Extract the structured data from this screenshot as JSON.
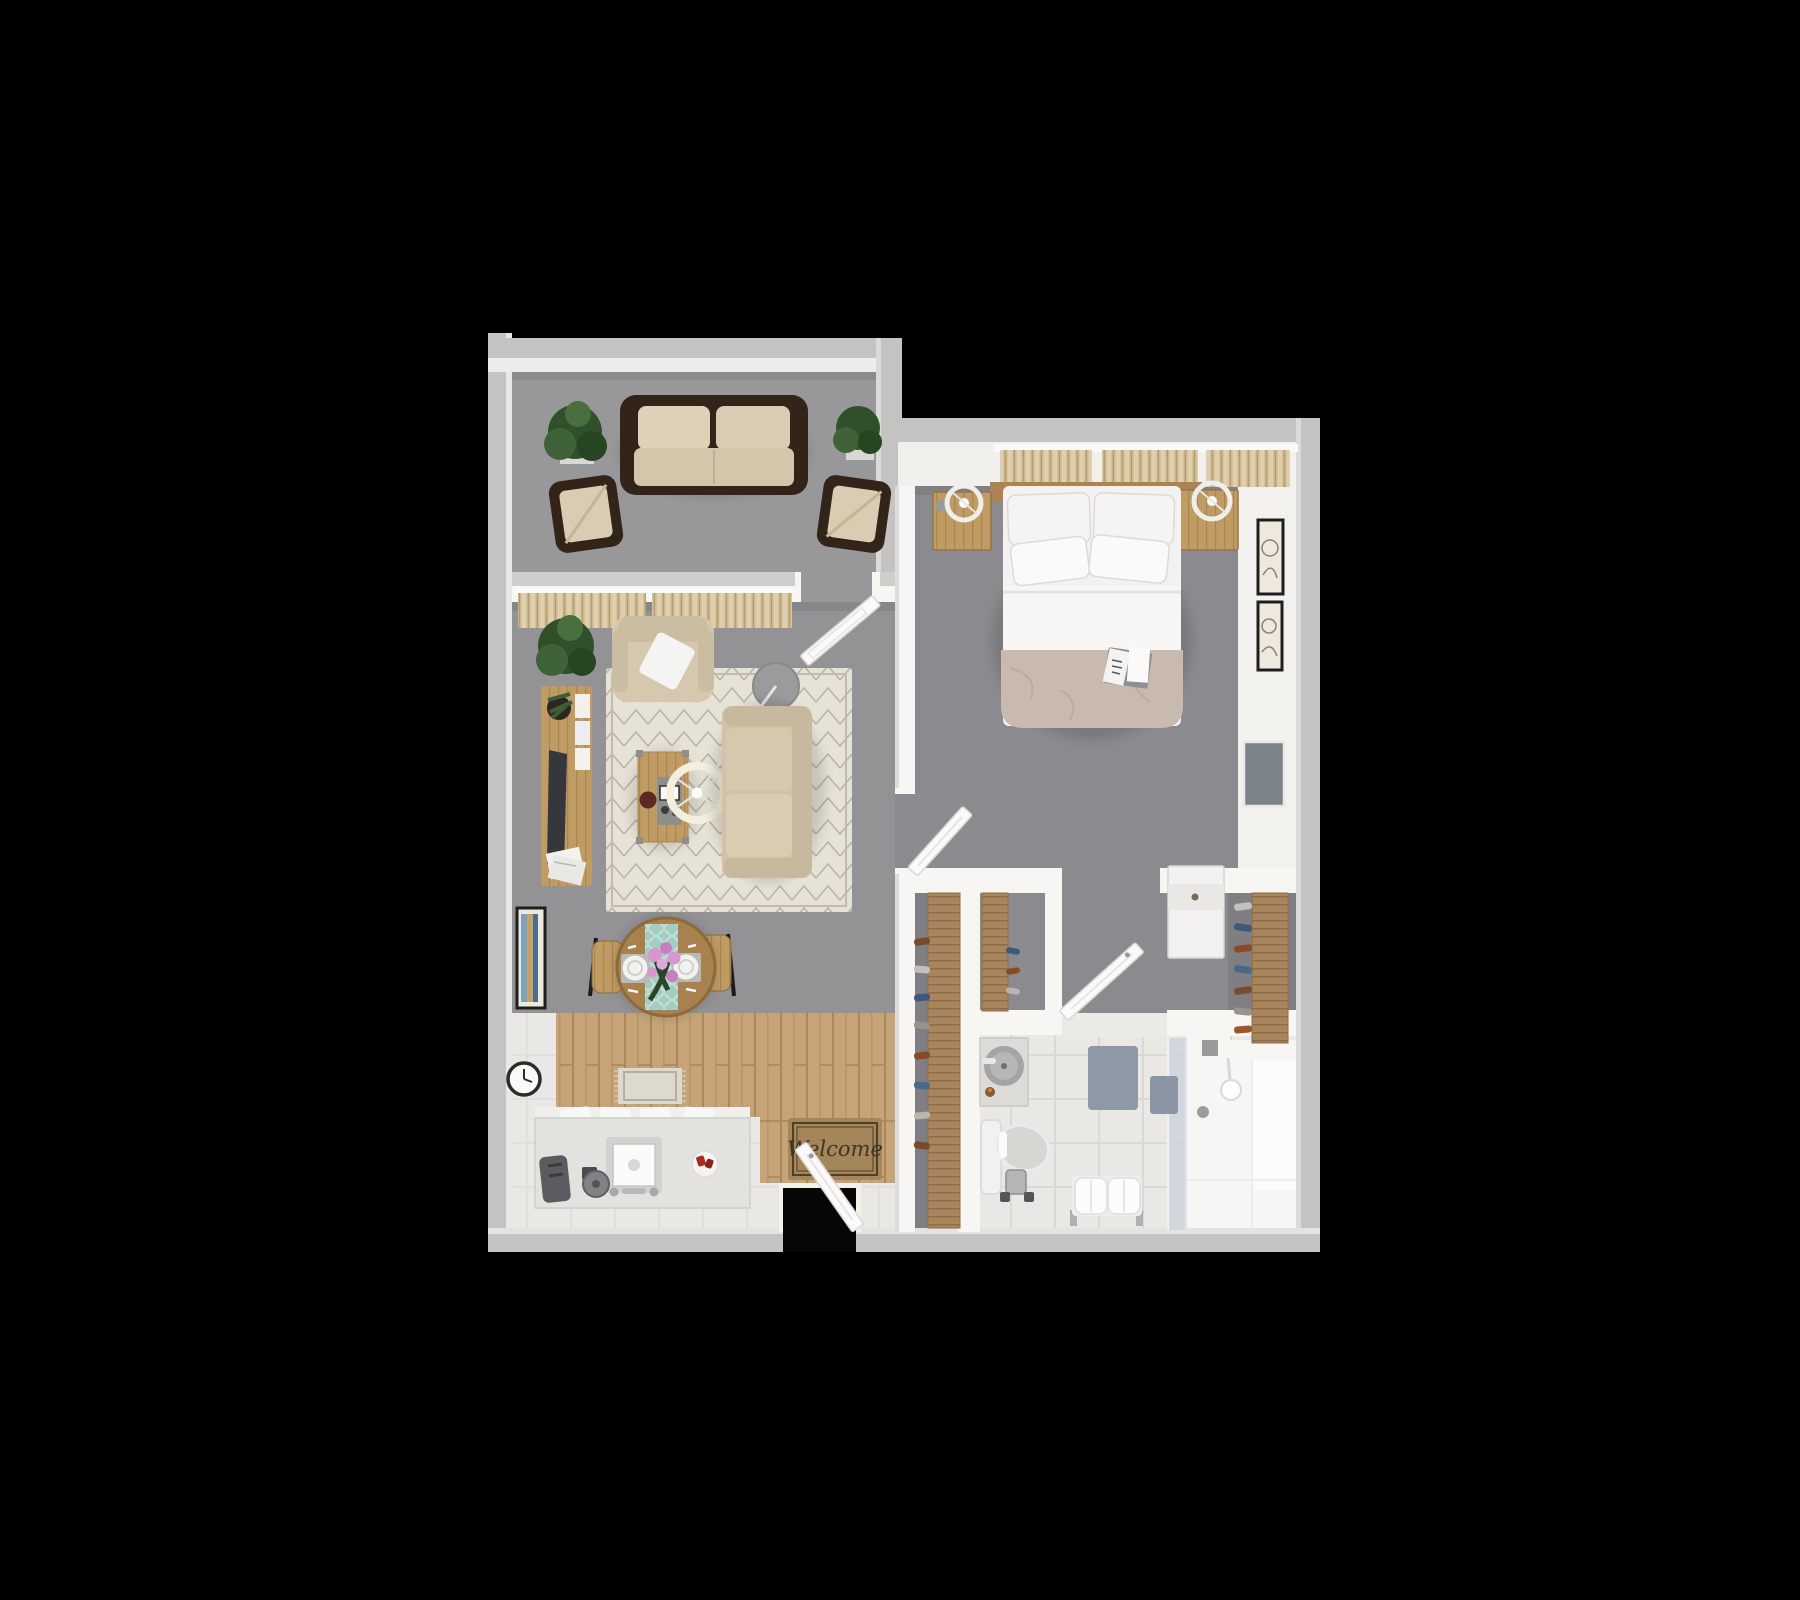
{
  "scene": {
    "type": "3d-floor-plan-top-down-render",
    "description": "One-bedroom apartment 3D floor plan viewed from above on black background",
    "background": "#000000"
  },
  "entry": {
    "mat_text": "Welcome"
  },
  "palette": {
    "outer_wall": "#c4c3c1",
    "outer_wall_top": "#e9e8e5",
    "inner_wall": "#f7f6f3",
    "carpet_patio": "#98989b",
    "carpet_living": "#939396",
    "carpet_bedroom": "#8b8b8f",
    "carpet_closet": "#7f7f83",
    "wood_floor": "#c6a478",
    "wood_furniture": "#b48e5c",
    "rug": "#e7e2d6",
    "sofa_fabric": "#d5c8ae",
    "outdoor_frame": "#33241a",
    "bed_linen": "#f3f2f0",
    "duvet": "#c9bab0",
    "curtain": "#d6c298",
    "table_runner": "#a5cec2",
    "flower_pink": "#d795d2",
    "plant_green": "#3e5c38",
    "tile": "#e9e8e5",
    "shower_white": "#f6f6f4",
    "bath_mat": "#8d99a7",
    "welcome_mat": "#a5855a",
    "tv_screen": "#35373c",
    "wall_tv": "#7b828a",
    "accent_red": "#a3301f",
    "frame_black": "#1e1e1e"
  },
  "rooms": {
    "patio": {
      "furniture": [
        "outdoor-sofa",
        "outdoor-armchair-left",
        "outdoor-armchair-right",
        "potted-plant-left",
        "potted-plant-right"
      ]
    },
    "living_room": {
      "furniture": [
        "curtains",
        "patio-door",
        "armchair",
        "floor-plant",
        "tv-console",
        "tv",
        "area-rug",
        "coffee-table",
        "arc-floor-lamp",
        "side-table",
        "sofa"
      ]
    },
    "dining_area": {
      "furniture": [
        "round-dining-table",
        "table-runner",
        "flower-centerpiece",
        "two-place-settings",
        "dining-chair-left",
        "dining-chair-right",
        "wall-art",
        "wall-clock"
      ]
    },
    "kitchen": {
      "furniture": [
        "counter-with-sink",
        "faucet",
        "toaster",
        "coffee-grinder",
        "plate-with-food",
        "small-rug"
      ]
    },
    "entry": {
      "furniture": [
        "welcome-mat",
        "front-door"
      ]
    },
    "bedroom": {
      "furniture": [
        "double-bed",
        "four-pillows",
        "duvet",
        "open-book",
        "headboard",
        "nightstand-left",
        "nightstand-right",
        "ring-lamp-left",
        "ring-lamp-right",
        "window-curtains",
        "bedroom-door",
        "wall-frames",
        "wall-tv",
        "dresser"
      ]
    },
    "closets": {
      "furniture": [
        "closet-shelf-left",
        "closet-shelf-middle",
        "closet-shelf-right",
        "hanging-clothes",
        "closet-door"
      ]
    },
    "bathroom": {
      "furniture": [
        "vanity-with-round-basin",
        "toilet",
        "toilet-paper-stand",
        "bath-mat",
        "glass-shower",
        "shower-head",
        "towel-on-glass",
        "towel-bench"
      ]
    }
  }
}
